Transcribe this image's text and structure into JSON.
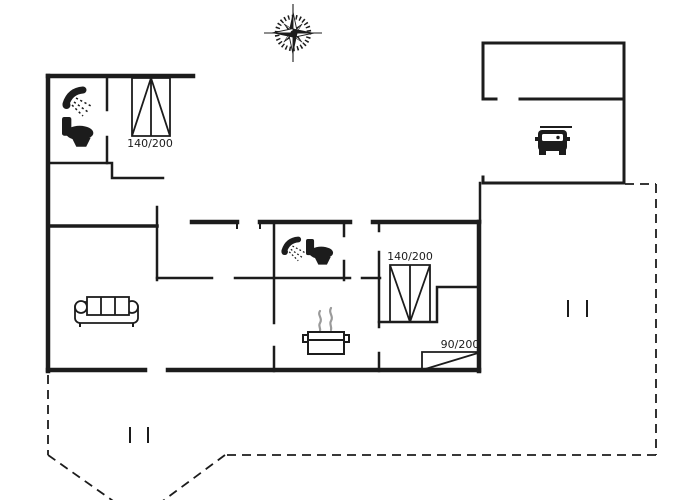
{
  "colors": {
    "background": "#ffffff",
    "ink": "#1c1c1c",
    "steam": "#9a9a9a"
  },
  "floor_plan": {
    "kind": "holiday-house-floor-plan",
    "beds": [
      {
        "id": "bed-northwest-double",
        "label": "140/200"
      },
      {
        "id": "bed-east-double",
        "label": "140/200"
      },
      {
        "id": "bed-southeast-single",
        "label": "90/200"
      }
    ],
    "symbols": [
      "compass-rose-icon",
      "shower-icon (x2)",
      "toilet-icon (x2)",
      "double-bed-symbol (x2)",
      "single-bed-symbol",
      "sofa-icon",
      "cooking-pot-icon",
      "car-icon",
      "terrace-dashed-outline",
      "terrace-marks"
    ]
  }
}
